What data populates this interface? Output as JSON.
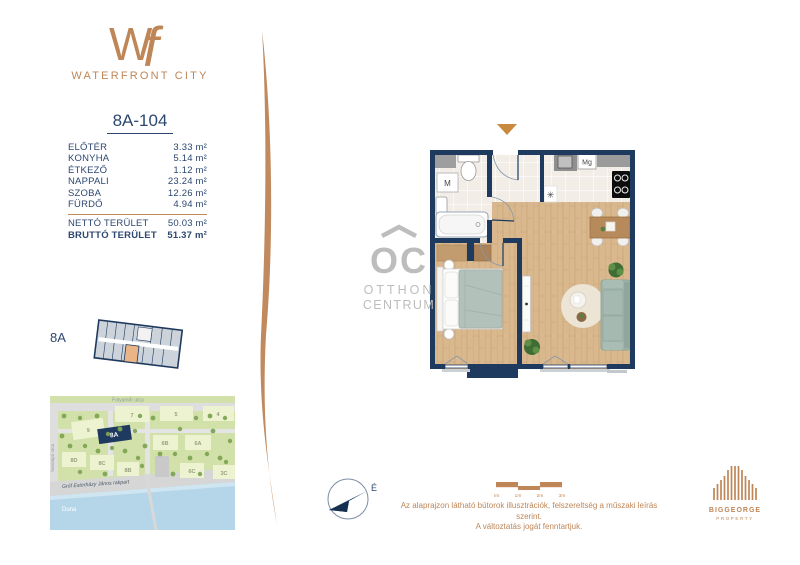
{
  "brand": {
    "monogram_w": "W",
    "monogram_f": "f",
    "name": "WATERFRONT CITY"
  },
  "unit": {
    "title": "8A-104",
    "rooms": [
      {
        "label": "ELŐTÉR",
        "area": "3.33 m²"
      },
      {
        "label": "KONYHA",
        "area": "5.14 m²"
      },
      {
        "label": "ÉTKEZŐ",
        "area": "1.12 m²"
      },
      {
        "label": "NAPPALI",
        "area": "23.24 m²"
      },
      {
        "label": "SZOBA",
        "area": "12.26 m²"
      },
      {
        "label": "FÜRDŐ",
        "area": "4.94 m²"
      }
    ],
    "totals": [
      {
        "label": "NETTÓ TERÜLET",
        "area": "50.03 m²"
      },
      {
        "label": "BRUTTÓ TERÜLET",
        "area": "51.37 m²"
      }
    ]
  },
  "keyplan": {
    "label": "8A"
  },
  "map": {
    "street_top": "Folyamőr utca",
    "street_left": "Sorompó utca",
    "street_embankment": "Gróf Esterházy János rakpart",
    "river": "Duna",
    "highlight_label": "8A",
    "buildings": [
      "7",
      "5",
      "4",
      "9",
      "6B",
      "6A",
      "8D",
      "8C",
      "8B",
      "6C",
      "3C"
    ]
  },
  "floorplan": {
    "washer_label": "M",
    "microwave_label": "Mg",
    "appliance_symbol": "✳"
  },
  "watermark": {
    "monogram": "OC",
    "line1": "OTTHON",
    "line2": "CENTRUM"
  },
  "compass": {
    "north": "É"
  },
  "scalebar": {
    "ticks": [
      "0m",
      "1m",
      "2m",
      "3m"
    ]
  },
  "disclaimer": {
    "line1": "Az alaprajzon látható bútorok illusztrációk, felszereltség a műszaki leírás szerint.",
    "line2": "A változtatás jogát fenntartjuk."
  },
  "developer": {
    "name": "BIGGEORGE",
    "subtitle": "PROPERTY"
  },
  "colors": {
    "accent": "#bf8657",
    "navy": "#1e3a5f"
  }
}
